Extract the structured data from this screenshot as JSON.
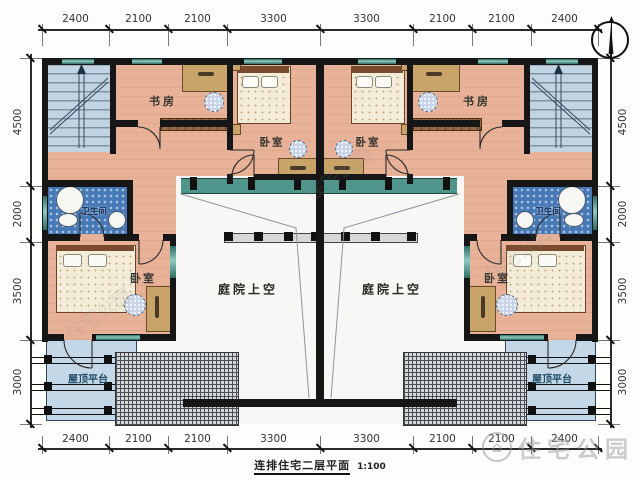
{
  "meta": {
    "title": "连排住宅二层平面",
    "scale": "1:100"
  },
  "watermark": {
    "brand": "住宅公园"
  },
  "dimensions": {
    "top": [
      "2400",
      "2100",
      "2100",
      "3300",
      "3300",
      "2100",
      "2100",
      "2400"
    ],
    "bottom": [
      "2400",
      "2100",
      "2100",
      "3300",
      "3300",
      "2100",
      "2100",
      "2400"
    ],
    "left": [
      "4500",
      "2000",
      "3500",
      "3000"
    ],
    "right": [
      "4500",
      "2000",
      "3500",
      "3000"
    ]
  },
  "rooms": {
    "study": "书房",
    "bedroom": "卧室",
    "bathroom": "卫生间",
    "courtyard": "庭院上空",
    "terrace": "屋顶平台"
  }
}
